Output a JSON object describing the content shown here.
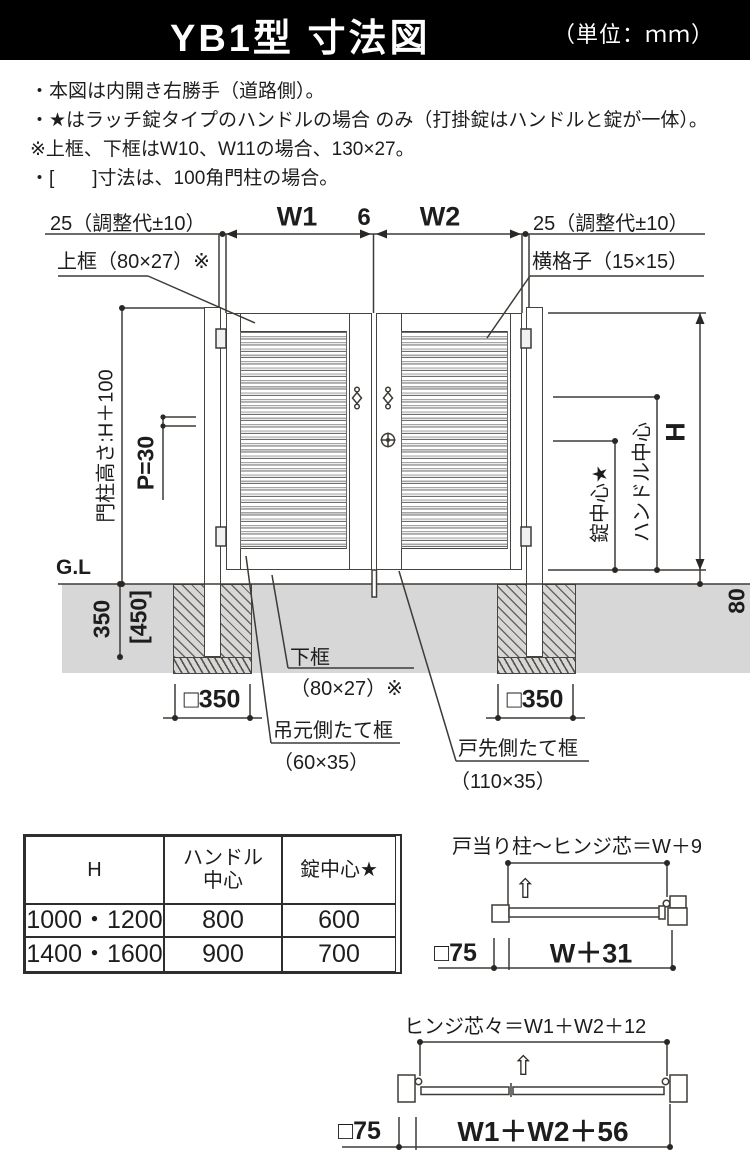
{
  "header": {
    "title": "YB1型 寸法図",
    "unit": "（単位：ｍｍ）",
    "bg": "#000000"
  },
  "notes": {
    "line1": "・本図は内開き右勝手（道路側）。",
    "line2": "・★はラッチ錠タイプのハンドルの場合 のみ（打掛錠はハンドルと錠が一体）。",
    "line3": "※上框、下框はW10、W11の場合、130×27。",
    "line4": "・[　　]寸法は、100角門柱の場合。"
  },
  "diagram": {
    "adjust_left": "25（調整代±10）",
    "adjust_right": "25（調整代±10）",
    "w1": "W1",
    "gap": "6",
    "w2": "W2",
    "top_rail": "上框（80×27）※",
    "lattice": "横格子（15×15）",
    "post_height": "門柱高さ:H＋100",
    "pitch": "P=30",
    "gl": "G.L",
    "embed_depth": "350",
    "embed_depth_bracket": "[450]",
    "footing_left": "□350",
    "footing_right": "□350",
    "bottom_rail": "下框",
    "bottom_rail_size": "（80×27）※",
    "hinge_stile": "吊元側たて框",
    "hinge_stile_size": "（60×35）",
    "latch_stile": "戸先側たて框",
    "latch_stile_size": "（110×35）",
    "lock_center": "錠中心★",
    "handle_center": "ハンドル中心",
    "height": "H",
    "clearance": "80"
  },
  "table": {
    "col_h": "H",
    "col_handle_line1": "ハンドル",
    "col_handle_line2": "中心",
    "col_lock": "錠中心★",
    "rows": [
      [
        "1000・1200",
        "800",
        "600"
      ],
      [
        "1400・1600",
        "900",
        "700"
      ]
    ]
  },
  "plan1": {
    "title": "戸当り柱～ヒンジ芯＝W＋9",
    "post": "□75",
    "span": "W＋31",
    "up_arrow": "⇧"
  },
  "plan2": {
    "title": "ヒンジ芯々＝W1＋W2＋12",
    "post": "□75",
    "span": "W1＋W2＋56",
    "up_arrow": "⇧"
  },
  "colors": {
    "line": "#46423e",
    "ground": "#d7d7d7",
    "header_bg": "#000000",
    "text": "#1d1d1d"
  }
}
